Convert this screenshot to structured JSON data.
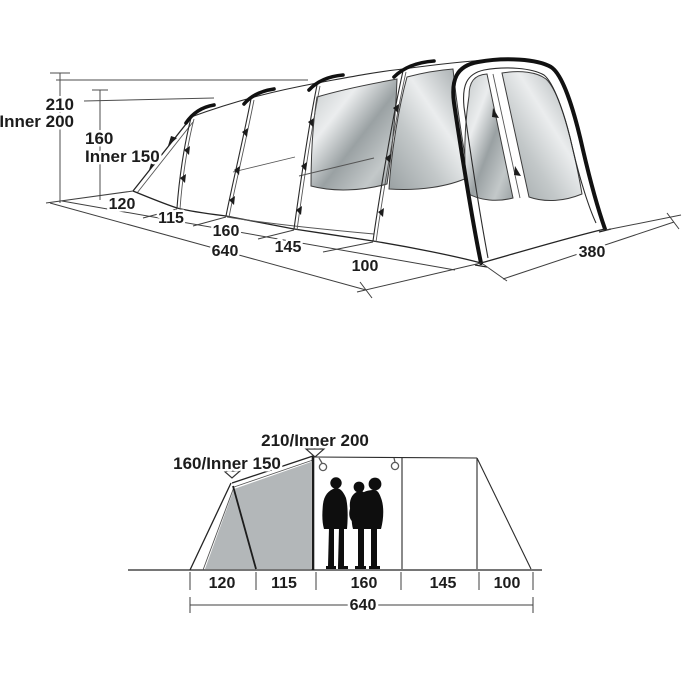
{
  "top_view": {
    "height_outer": "210",
    "height_inner": "Inner 200",
    "porch_height": "160",
    "porch_inner": "Inner 150",
    "segments": [
      "120",
      "115",
      "160",
      "145",
      "100"
    ],
    "total_length": "640",
    "front_width": "380"
  },
  "side_view": {
    "peak_height": "210/Inner 200",
    "porch_height": "160/Inner 150",
    "segments": [
      "120",
      "115",
      "160",
      "145",
      "100"
    ],
    "total_length": "640"
  },
  "colors": {
    "line": "#242424",
    "bedroom_fill": "#b3b7b9",
    "window_dark": "#9aa1a3",
    "window_mid": "#c3c8c9",
    "window_light": "#ebedee"
  }
}
